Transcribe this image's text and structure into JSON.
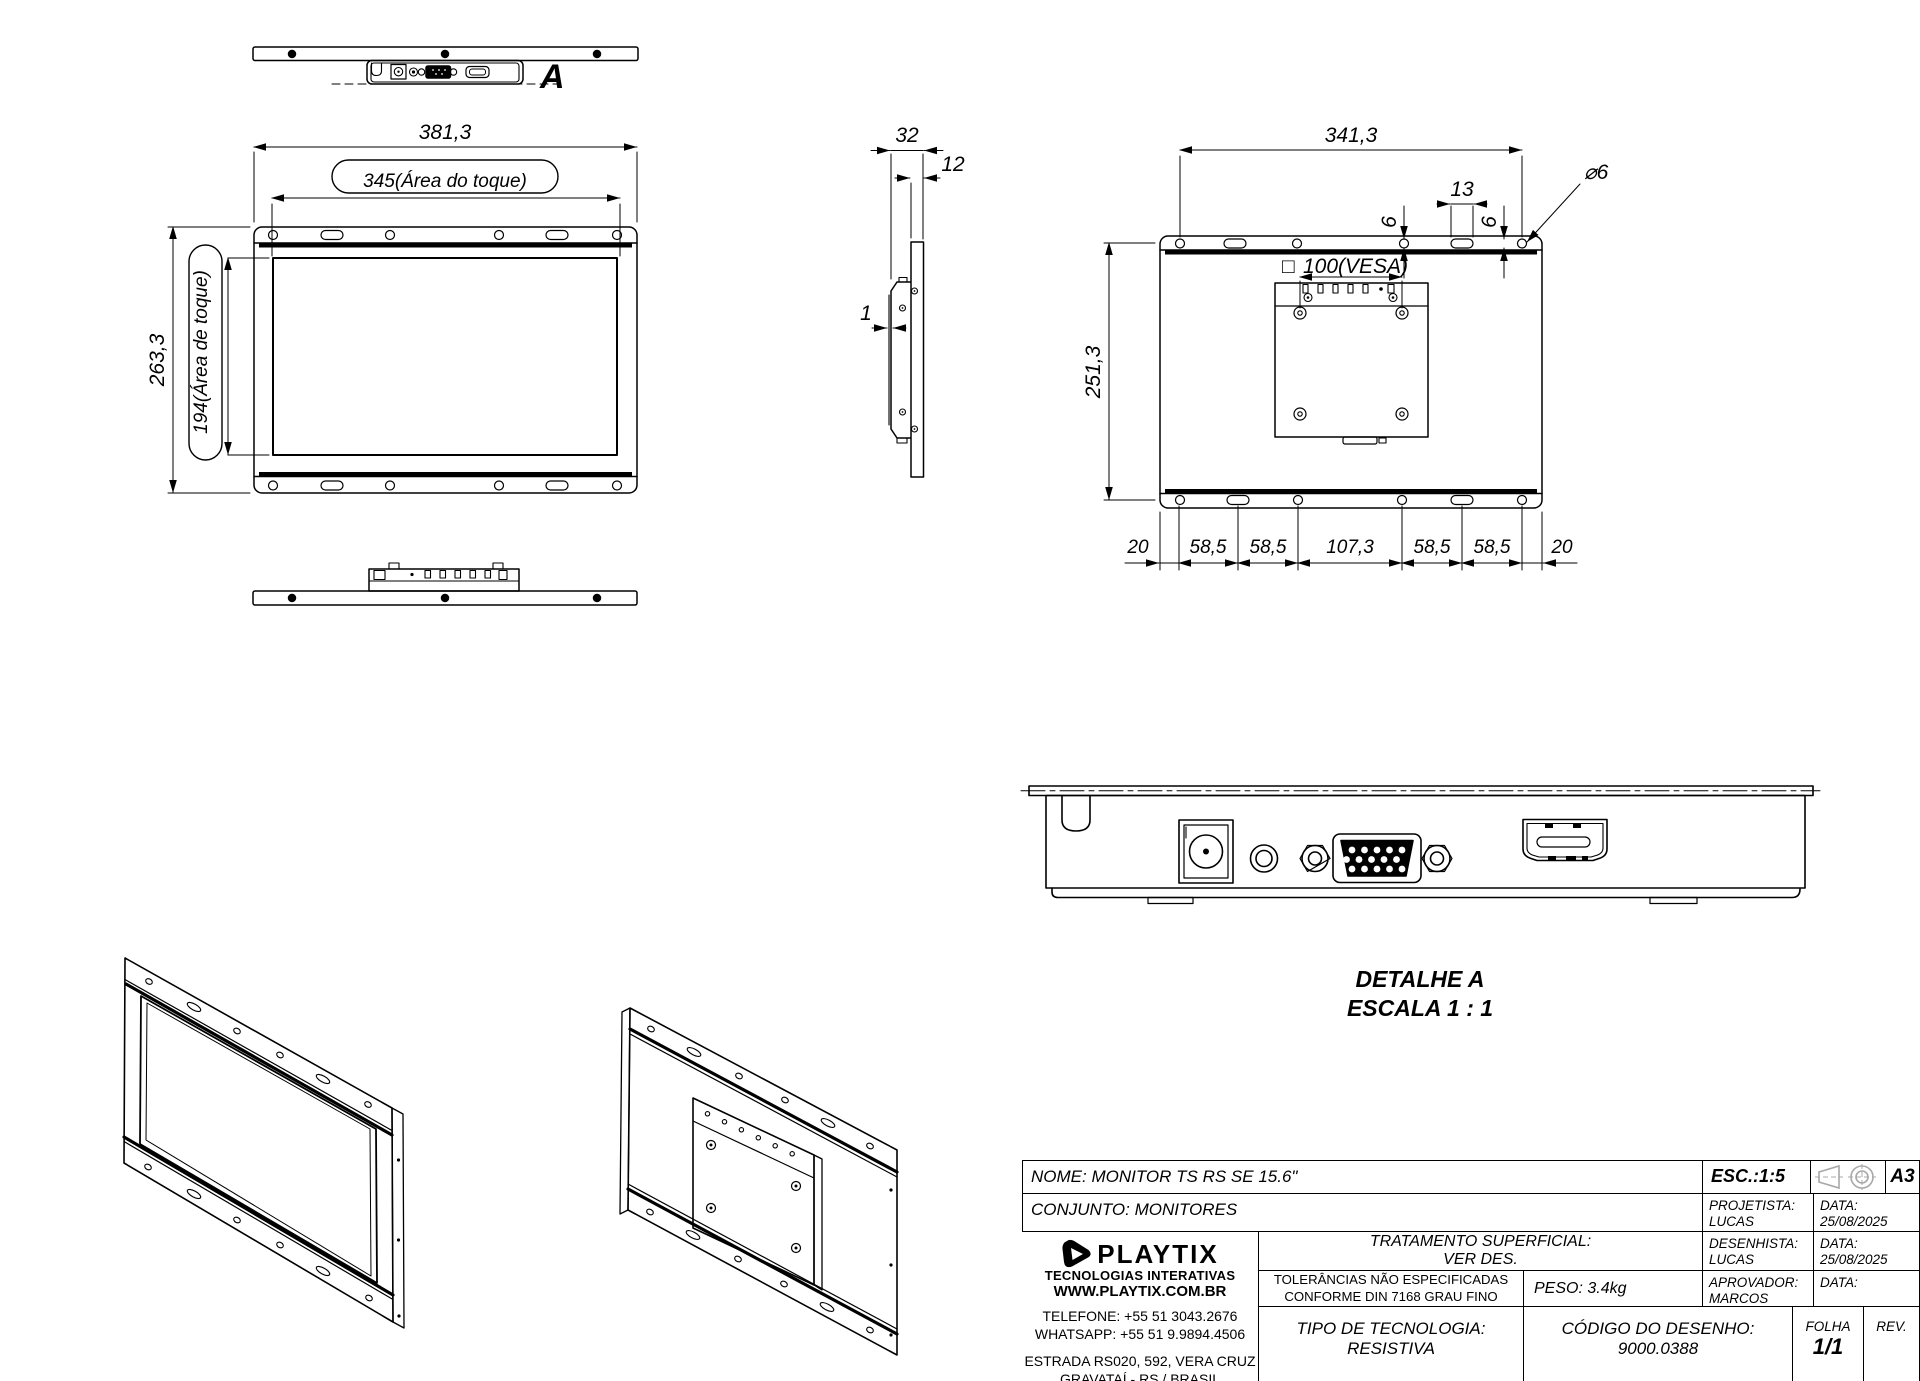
{
  "views": {
    "top_view": {
      "label": "A"
    },
    "front_view": {
      "width": "381,3",
      "touch_width": "345(Área do toque)",
      "height": "263,3",
      "touch_height": "194(Área de toque)"
    },
    "side_view": {
      "depth": "32",
      "front_depth": "12",
      "glass_thickness": "1"
    },
    "rear_view": {
      "mount_span": "341,3",
      "slot_width": "13",
      "edge_offset_a": "6",
      "edge_offset_b": "6",
      "hole_diameter": "⌀6",
      "vesa_square": "□",
      "vesa": "100(VESA)",
      "height": "251,3",
      "bottom_chain": [
        "20",
        "58,5",
        "58,5",
        "107,3",
        "58,5",
        "58,5",
        "20"
      ]
    },
    "detail_a": {
      "title": "DETALHE A",
      "scale": "ESCALA 1 : 1"
    }
  },
  "title_block": {
    "nome": "NOME: MONITOR TS RS SE 15.6\"",
    "conjunto": "CONJUNTO: MONITORES",
    "esc": "ESC.:1:5",
    "paper_size": "A3",
    "projetista_label": "PROJETISTA:",
    "projetista": "LUCAS EVALDT",
    "data1_label": "DATA:",
    "data1": "25/08/2025",
    "desenhista_label": "DESENHISTA:",
    "desenhista": "LUCAS EVALDT",
    "data2_label": "DATA:",
    "data2": "25/08/2025",
    "aprovador_label": "APROVADOR:",
    "aprovador": "MARCOS",
    "data3_label": "DATA:",
    "tratamento_1": "TRATAMENTO SUPERFICIAL:",
    "tratamento_2": "VER DES.",
    "tolerancias_1": "TOLERÂNCIAS NÃO ESPECIFICADAS",
    "tolerancias_2": "CONFORME DIN 7168 GRAU FINO",
    "peso": "PESO: 3.4kg",
    "tipo_1": "TIPO DE TECNOLOGIA:",
    "tipo_2": "RESISTIVA",
    "codigo_1": "CÓDIGO DO DESENHO:",
    "codigo_2": "9000.0388",
    "folha_label": "FOLHA",
    "folha": "1/1",
    "rev_label": "REV.",
    "logo": {
      "brand": "PLAYTIX",
      "tagline": "TECNOLOGIAS INTERATIVAS",
      "site": "WWW.PLAYTIX.COM.BR",
      "telefone": "TELEFONE: +55 51 3043.2676",
      "whatsapp": "WHATSAPP: +55 51 9.9894.4506",
      "endereco_1": "ESTRADA RS020, 592, VERA CRUZ",
      "endereco_2": "GRAVATAÍ - RS / BRASIL"
    }
  }
}
